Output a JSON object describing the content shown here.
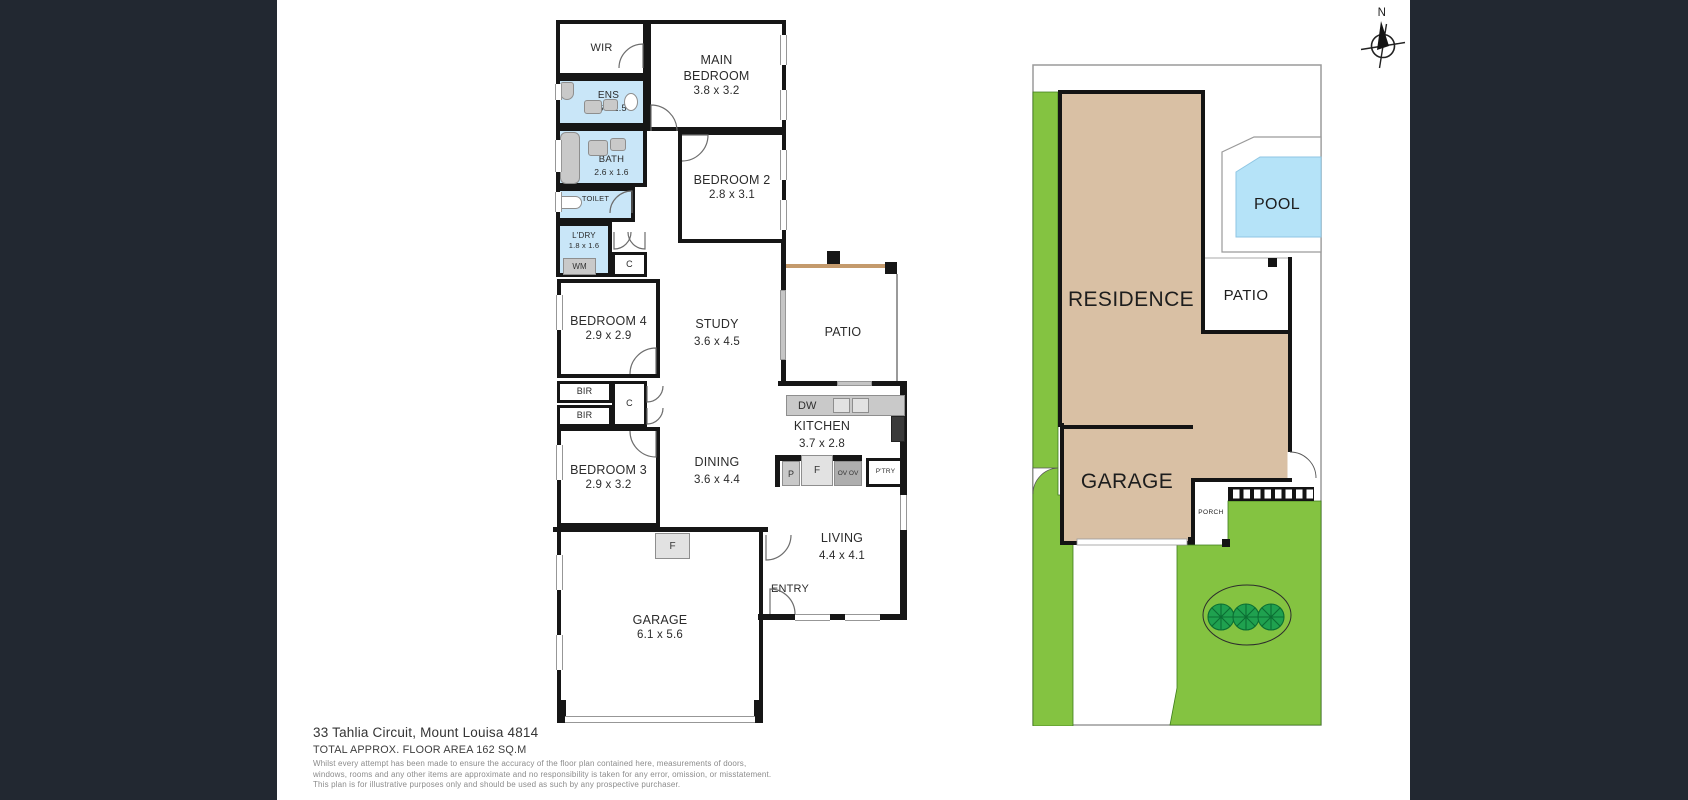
{
  "compass": {
    "label": "N"
  },
  "floorplan": {
    "rooms": {
      "wir": {
        "name": "WIR"
      },
      "ens": {
        "name": "ENS",
        "dims": "2.6 x 1.5"
      },
      "bath": {
        "name": "BATH",
        "dims": "2.6 x 1.6"
      },
      "toilet": {
        "name": "TOILET"
      },
      "laundry": {
        "name": "L'DRY",
        "dims": "1.8 x 1.6"
      },
      "main_bedroom": {
        "line1": "MAIN",
        "line2": "BEDROOM",
        "dims": "3.8 x 3.2"
      },
      "bedroom2": {
        "name": "BEDROOM 2",
        "dims": "2.8 x 3.1"
      },
      "bedroom3": {
        "name": "BEDROOM 3",
        "dims": "2.9 x 3.2"
      },
      "bedroom4": {
        "name": "BEDROOM 4",
        "dims": "2.9 x 2.9"
      },
      "study": {
        "name": "STUDY",
        "dims": "3.6 x 4.5"
      },
      "patio": {
        "name": "PATIO"
      },
      "kitchen": {
        "name": "KITCHEN",
        "dims": "3.7 x 2.8"
      },
      "dining": {
        "name": "DINING",
        "dims": "3.6 x 4.4"
      },
      "living": {
        "name": "LIVING",
        "dims": "4.4 x 4.1"
      },
      "entry": {
        "name": "ENTRY"
      },
      "garage": {
        "name": "GARAGE",
        "dims": "6.1 x 5.6"
      }
    },
    "fixtures": {
      "wm": "WM",
      "cupboard": "C",
      "bir": "BIR",
      "dw": "DW",
      "p": "P",
      "fridge": "F",
      "ovens": "OV OV",
      "pantry": "P'TRY",
      "garage_f": "F"
    }
  },
  "siteplan": {
    "labels": {
      "residence": "RESIDENCE",
      "garage": "GARAGE",
      "patio": "PATIO",
      "pool": "POOL",
      "porch": "PORCH"
    }
  },
  "footer": {
    "address": "33 Tahlia Circuit, Mount Louisa 4814",
    "floor_area": "TOTAL APPROX. FLOOR AREA 162 SQ.M",
    "disclaimer1": "Whilst every attempt has been made to ensure the accuracy of the floor plan contained here, measurements of doors,",
    "disclaimer2": "windows, rooms and any other items are approximate and no responsibility is taken for any error, omission, or misstatement.",
    "disclaimer3": "This plan is for illustrative purposes only and should be used as such by any prospective purchaser."
  },
  "colors": {
    "background_side": "#222831",
    "panel": "#ffffff",
    "wall": "#161616",
    "wet_room": "#c9e6f8",
    "residence_fill": "#d9c0a4",
    "grass": "#84c341",
    "tree": "#1fa14f",
    "pool": "#b5e3f8",
    "beam": "#c49a6c"
  }
}
